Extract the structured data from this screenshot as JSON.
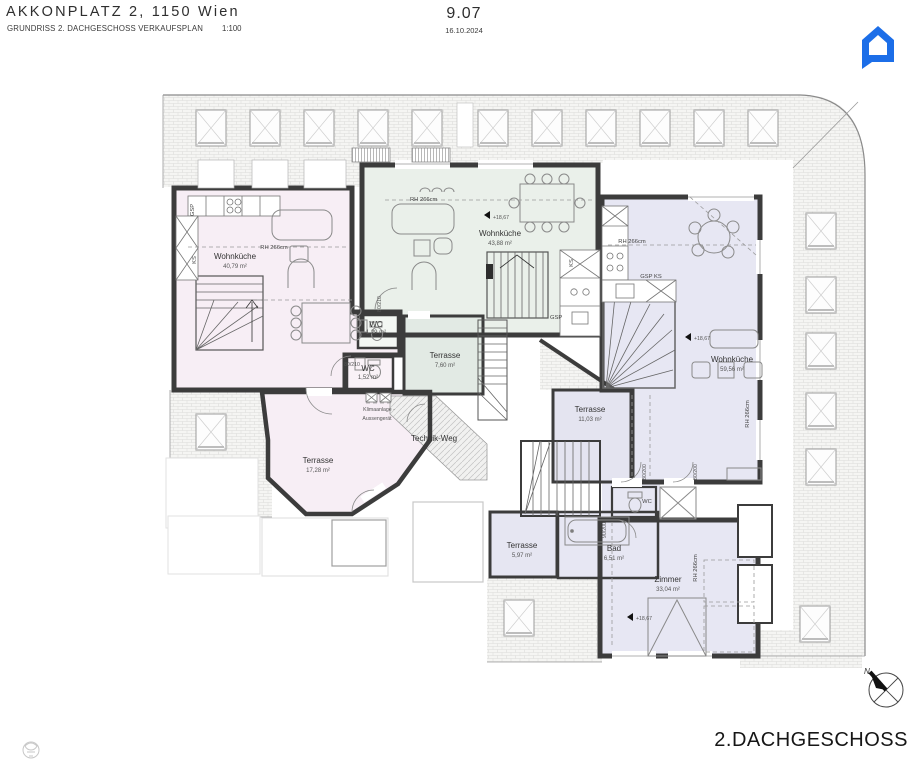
{
  "header": {
    "title": "AKKONPLATZ 2, 1150 Wien",
    "subtitle": "GRUNDRISS 2. DACHGESCHOSS VERKAUFSPLAN",
    "scale": "1:100",
    "plan_number": "9.07",
    "date": "16.10.2024"
  },
  "branding": {
    "logo": "house-chat-logo",
    "logo_color": "#1c6ee8"
  },
  "footer": {
    "floor_label": "2.DACHGESCHOSS"
  },
  "compass": {
    "north": "N"
  },
  "rooms": {
    "left_living": {
      "name": "Wohnküche",
      "area": "40,79 m²"
    },
    "mid_living": {
      "name": "Wohnküche",
      "area": "43,88 m²"
    },
    "right_living": {
      "name": "Wohnküche",
      "area": "59,56 m²"
    },
    "wc_mid": {
      "name": "WC",
      "area": "1,29 m²"
    },
    "wc_left": {
      "name": "WC",
      "area": "1,52 m²"
    },
    "wc_right": {
      "name": "WC"
    },
    "bad": {
      "name": "Bad",
      "area": "6,51 m²"
    },
    "zimmer": {
      "name": "Zimmer",
      "area": "33,04 m²"
    },
    "terrace_left": {
      "name": "Terrasse",
      "area": "17,28 m²"
    },
    "terrace_mid": {
      "name": "Terrasse",
      "area": "7,60 m²"
    },
    "terrace_right": {
      "name": "Terrasse",
      "area": "11,03 m²"
    },
    "terrace_small": {
      "name": "Terrasse",
      "area": "5,97 m²"
    }
  },
  "annotations": {
    "room_height": "RH 266cm",
    "level": "+18,67",
    "ks": "KS",
    "gsp": "GSP",
    "gsp_ks": "GSP  KS",
    "klima_line1": "Klimaanlage -",
    "klima_line2": "Aussengerät",
    "technik_weg": "Technik-Weg",
    "door_80_210": "80/210",
    "door_80_200": "80/200",
    "door_90_200": "90/200"
  },
  "colors": {
    "wall": "#3c3c3c",
    "apartment_pink": "#f7eef5",
    "apartment_mint": "#eaf0ea",
    "apartment_lavender": "#e7e7f3",
    "logo_blue": "#1c6ee8"
  }
}
